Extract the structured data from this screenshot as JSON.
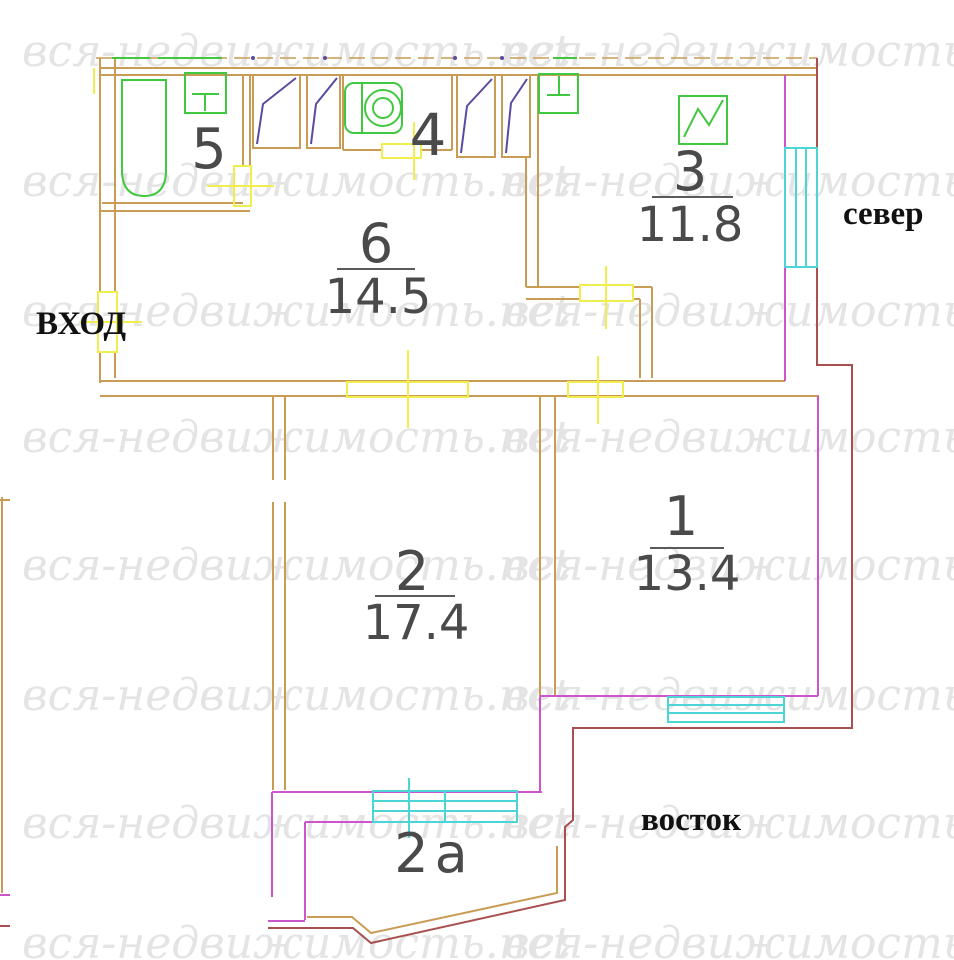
{
  "watermark": {
    "text": "вся-недвижимость.net"
  },
  "compass": {
    "north_label": "север",
    "east_label": "восток"
  },
  "entrance": {
    "label": "ВХОД"
  },
  "rooms": {
    "r5": {
      "number": "5"
    },
    "r4": {
      "number": "4"
    },
    "r6": {
      "number": "6",
      "area": "14.5"
    },
    "r3": {
      "number": "3",
      "area": "11.8"
    },
    "r2": {
      "number": "2",
      "area": "17.4"
    },
    "r1": {
      "number": "1",
      "area": "13.4"
    },
    "r2a": {
      "number": "2а"
    }
  },
  "colors": {
    "outer_wall": "#a85050",
    "inner_wall": "#c99c55",
    "partition": "#cc55cc",
    "window": "#4dd4d4",
    "door_marker": "#f0ee4e",
    "fixture": "#41c841",
    "closet_door": "#5a4aa0",
    "room_label": "#4a4a4a",
    "watermark": "#e4e4e4",
    "compass_text": "#111111"
  }
}
